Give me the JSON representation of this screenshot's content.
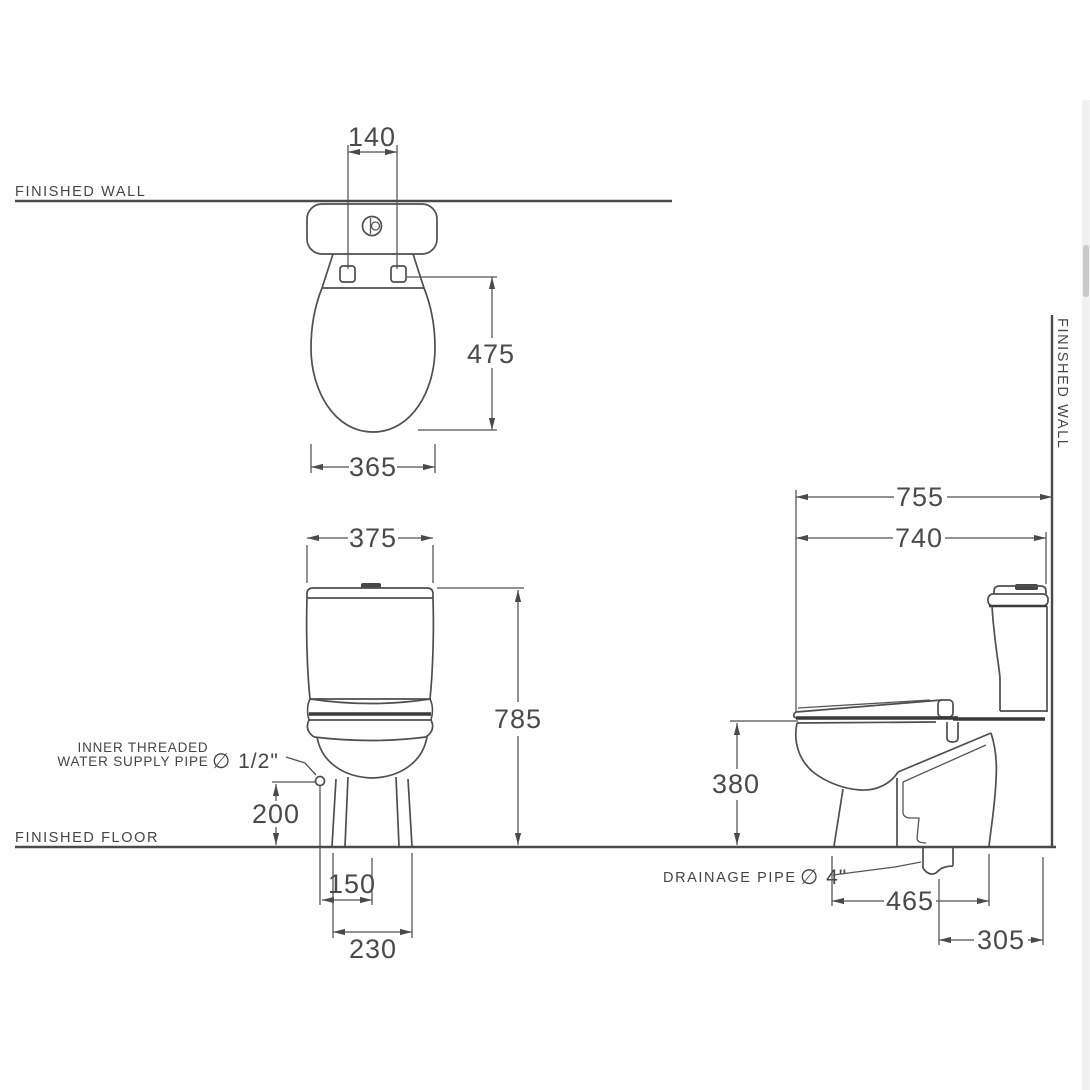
{
  "labels": {
    "finished_wall": "FINISHED WALL",
    "finished_floor": "FINISHED FLOOR",
    "supply_line1": "INNER THREADED",
    "supply_line2": "WATER SUPPLY PIPE",
    "supply_diameter": "∅ 1/2\"",
    "drain_label": "DRAINAGE PIPE",
    "drain_diameter": "∅ 4\""
  },
  "dims": {
    "d140": "140",
    "d475": "475",
    "d365": "365",
    "d375": "375",
    "d785": "785",
    "d200": "200",
    "d150": "150",
    "d230": "230",
    "d755": "755",
    "d740": "740",
    "d380": "380",
    "d465": "465",
    "d305": "305"
  }
}
